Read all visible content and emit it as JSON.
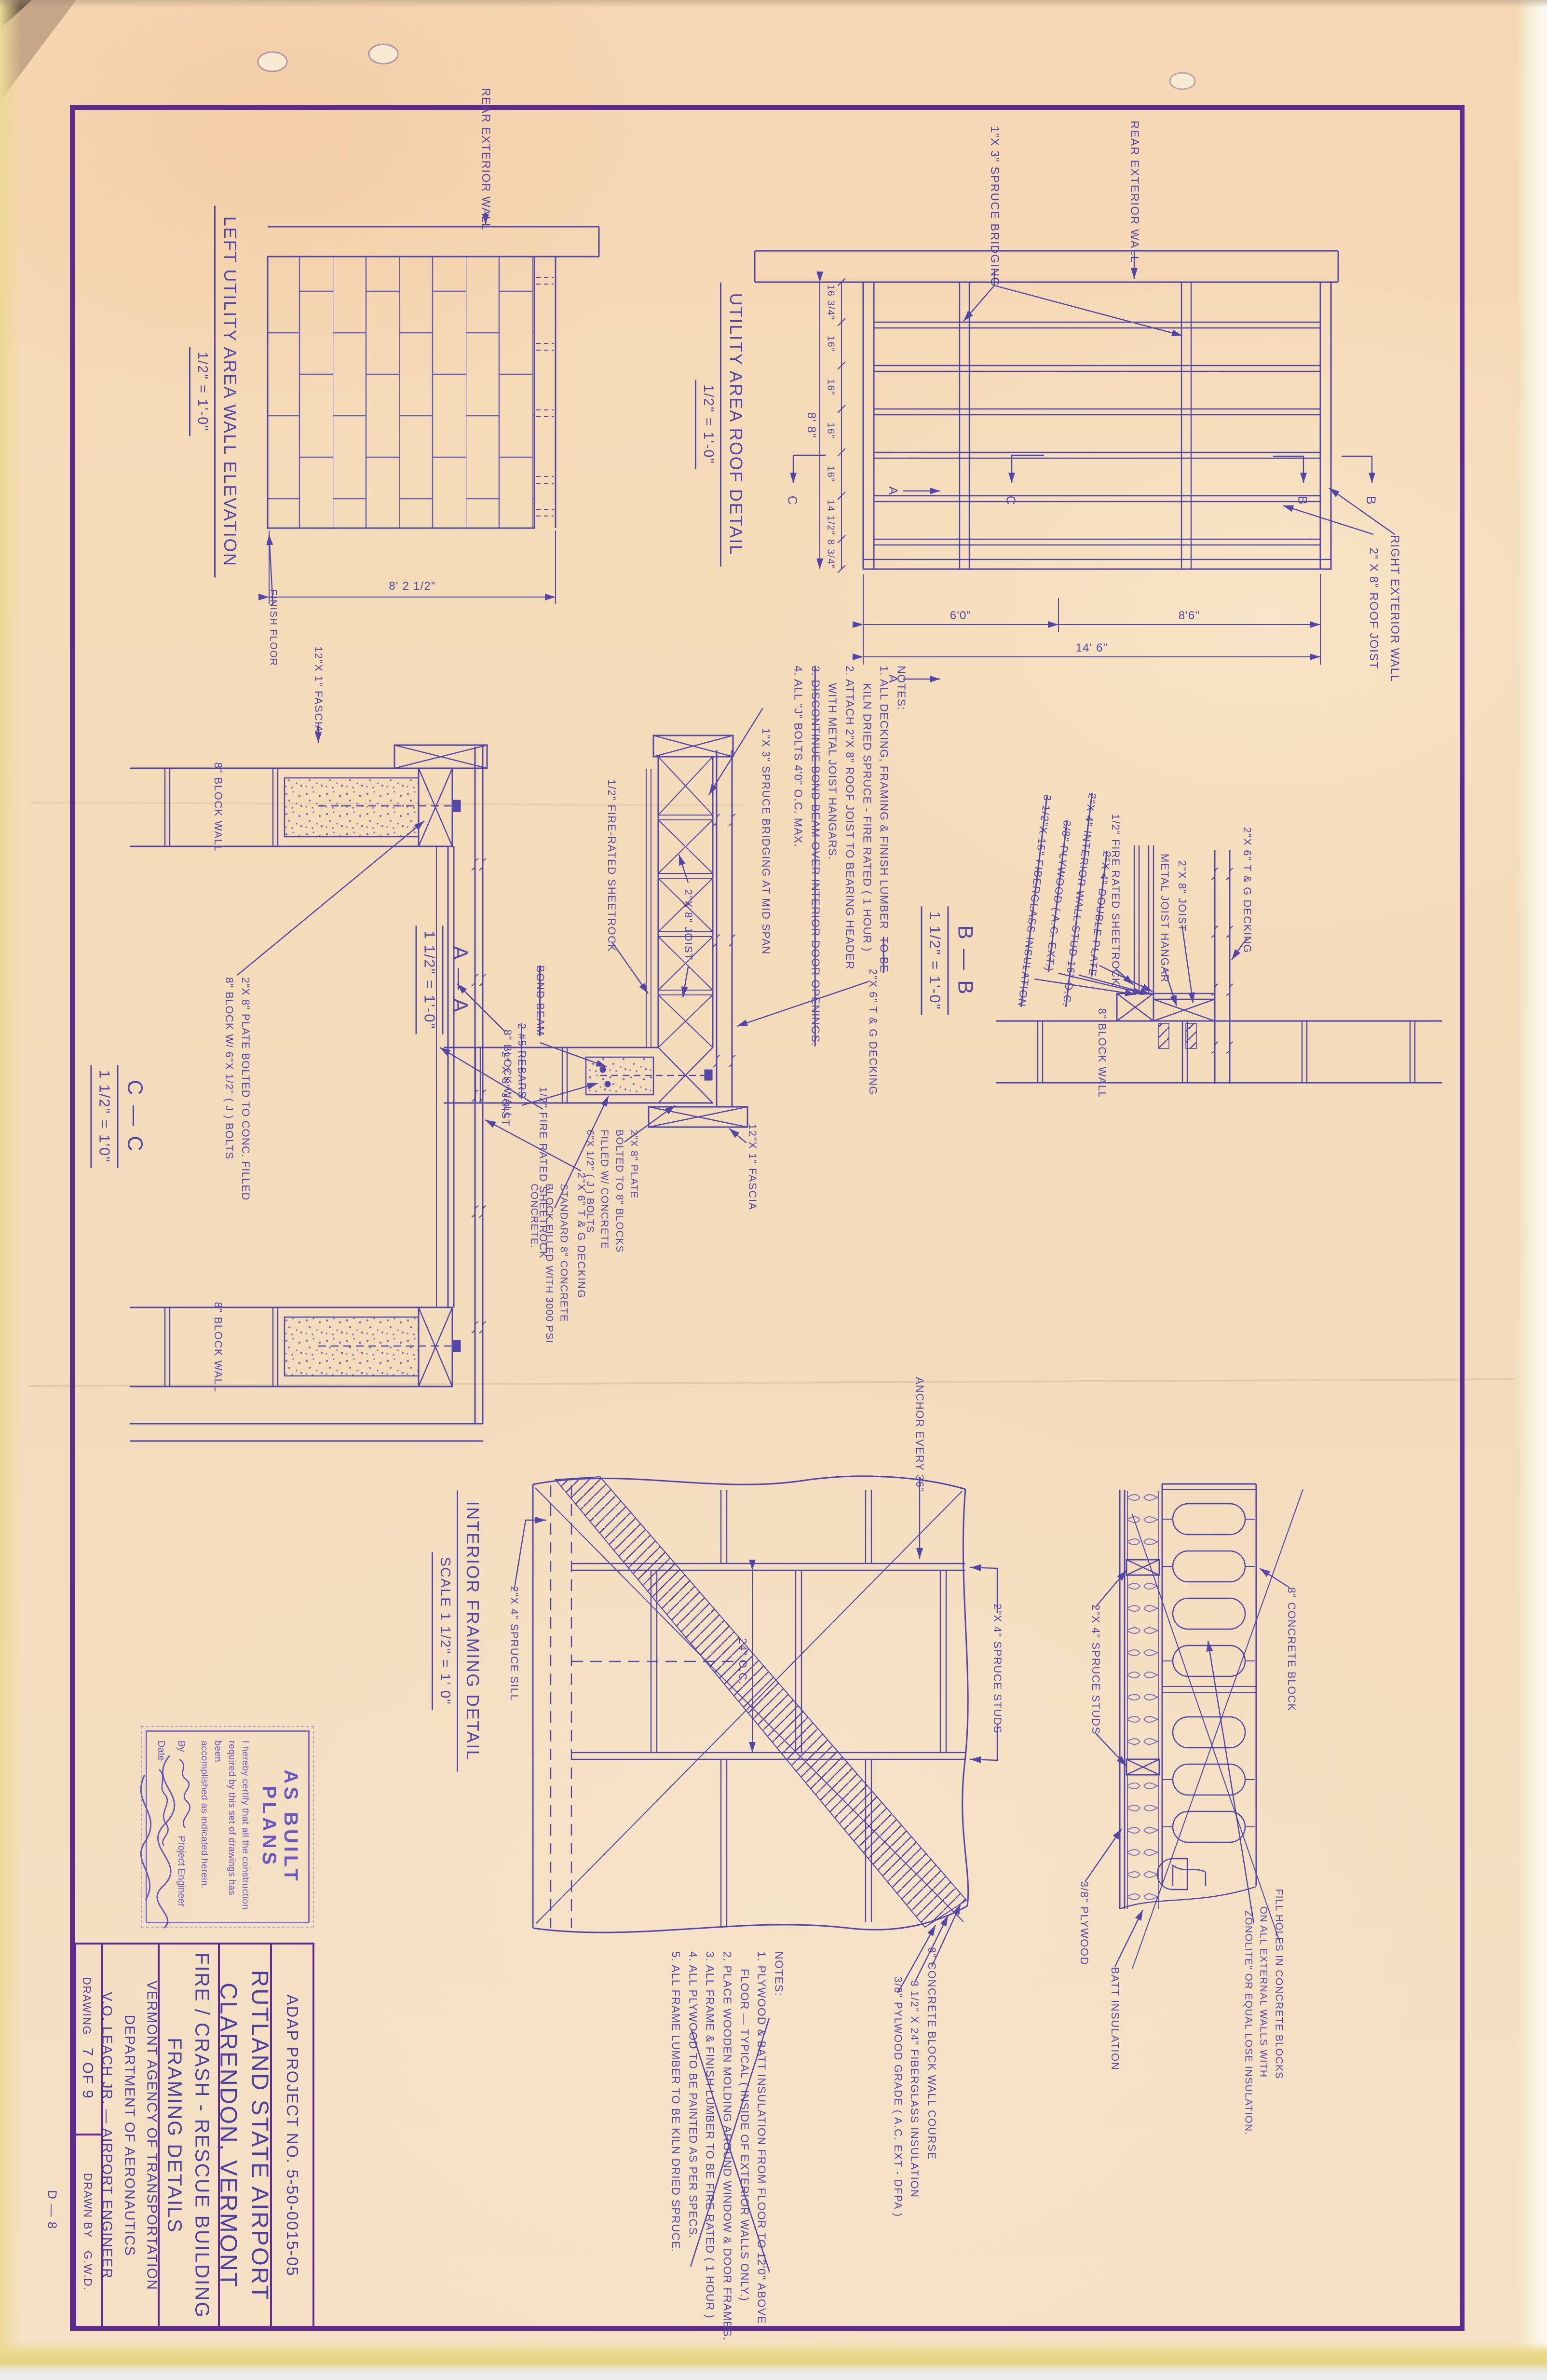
{
  "palette": {
    "paper": "#f4dcba",
    "ink": "#5246a8",
    "frame": "#5e2c90",
    "stamp": "#6a58c2"
  },
  "sheet": {
    "drawing_code": "D — 8",
    "title_block": {
      "project_no": "ADAP  PROJECT  NO.  5-50-0015-05",
      "airport_line1": "RUTLAND   STATE   AIRPORT",
      "airport_line2": "CLARENDON,  VERMONT",
      "subject_line1": "FIRE / CRASH - RESCUE  BUILDING",
      "subject_line2": "FRAMING   DETAILS",
      "agency_line1": "VERMONT  AGENCY  OF  TRANSPORTATION",
      "agency_line2": "DEPARTMENT  OF  AERONAUTICS",
      "agency_line3": "V.O. LEACH  JR.  —  AIRPORT  ENGINEER",
      "drawing_label": "DRAWING",
      "drawing_no": "7 OF 9",
      "drawn_by_label": "DRAWN BY",
      "drawn_by": "G.W.D."
    },
    "stamp": {
      "title": "AS BUILT PLANS",
      "line1": "I hereby certify that all the construction",
      "line2": "required by this set of drawings has been",
      "line3": "accomplished as indicated herein.",
      "by_label": "By",
      "by_role": "Project Engineer",
      "date_label": "Date"
    }
  },
  "elevation": {
    "title": "LEFT  UTILITY  AREA  WALL  ELEVATION",
    "scale": "1/2\" = 1'-0\"",
    "rear_wall": "REAR  EXTERIOR  WALL",
    "finish_floor": "FINISH  FLOOR",
    "width_dim": "8' 2 1/2\""
  },
  "roof": {
    "title": "UTILITY  AREA  ROOF  DETAIL",
    "scale": "1/2\" = 1'-0\"",
    "bridging": "1\"X 3\"  SPRUCE  BRIDGING",
    "rear_wall": "REAR  EXTERIOR  WALL",
    "right_wall": "RIGHT  EXTERIOR  WALL",
    "roof_joist": "2\" X 8\"  ROOF  JOIST",
    "dims_left": [
      "16 3/4\"",
      "16\"",
      "16\"",
      "16\"",
      "16\"",
      "14 1/2\"",
      "8 3/4\""
    ],
    "dim_left_overall": "8' 8\"",
    "dims_bottom": [
      "6'0\"",
      "8'6\""
    ],
    "dim_bottom_overall": "14' 6\"",
    "marker_a": "A",
    "marker_b": "B",
    "marker_c": "C"
  },
  "notes_top": {
    "heading": "NOTES:",
    "n1a": "1.  ALL DECKING, FRAMING & FINISH LUMBER",
    "n1_struck": "TO BE",
    "n1b": "KILN DRIED SPRUCE - FIRE RATED ( 1 HOUR )",
    "n2a": "2.  ATTACH 2\"X 8\" ROOF JOIST TO BEARING HEADER",
    "n2b": "WITH METAL JOIST HANGARS.",
    "n3": "3.  DISCONTINUE BOND BEAM OVER INTERIOR DOOR OPENINGS.",
    "n4": "4.  ALL \"J\" BOLTS 4'0\" O.C. MAX."
  },
  "section_c": {
    "label": "C — C",
    "scale": "1 1/2\" = 1'0\"",
    "fascia": "12\"X 1\" FASCIA",
    "block_wall": "8\" BLOCK  WALL",
    "block_wall2": "8\" BLOCK  WALL",
    "plate_l1": "2\"X 8\"  PLATE  BOLTED  TO  CONC.  FILLED",
    "plate_l2": "8\" BLOCK  W/ 6\"X 1/2\" ( J )  BOLTS",
    "joist": "2\" X 8\"  JOIST",
    "sheetrock": "1/2\"  FIRE  RATED  SHEETROCK",
    "decking": "2\"X 6\"  T & G  DECKING"
  },
  "section_a": {
    "label": "A — A",
    "scale": "1 1/2\" = 1'-0\"",
    "bridging": "1\"X 3\"  SPRUCE  BRIDGING  AT  MID  SPAN",
    "sheetrock": "1/2\"  FIRE-RATED  SHEETROCK",
    "joist": "2\"X 8\"  JOIST",
    "decking": "2\"X 6\"  T & G  DECKING",
    "bond_beam": "BOND  BEAM",
    "rebars": "2  #5  REBARS",
    "plate_l1": "2\"X 8\"  PLATE",
    "plate_l2": "BOLTED  TO  8\" BLOCKS",
    "plate_l3": "FILLED  W/  CONCRETE",
    "plate_l4": "6\"X 1/2\"  ( J ) BOLTS",
    "block_wall": "8\" BLOCK  WALL",
    "standard_l1": "STANDARD  8\"  CONCRETE",
    "standard_l2": "BLOCK  FILLED  WITH  3000 PSI",
    "standard_l3": "CONCRETE.",
    "fascia": "12\"X 1\"  FASCIA"
  },
  "section_b": {
    "label": "B — B",
    "scale": "1 1/2\" = 1'-0\"",
    "fiberglass": "3 1/2\"X 15\"  FIBERGLASS  INSULATION",
    "plywood": "3/8\"  PLYWOOD  ( A.C.  EXT.)",
    "stud": "2\"X 4\"  INTERIOR  WALL  STUD  16\"  O.C.",
    "double_plate": "2\"X 4\"  DOUBLE  PLATE",
    "sheetrock": "1/2\"  FIRE  RATED  SHEETROCK",
    "hangar": "METAL  JOIST  HANGAR",
    "joist": "2\"X 8\"  JOIST",
    "decking": "2\"X 6\"  T & G  DECKING",
    "block_wall": "8\" BLOCK  WALL"
  },
  "interior": {
    "title": "INTERIOR  FRAMING  DETAIL",
    "scale": "SCALE  1 1/2\" = 1' 0\"",
    "sill": "2\"X 4\"  SPRUCE  SILL",
    "anchor": "ANCHOR  EVERY  36\"",
    "oc": "24\" O.C.",
    "studs": "2\"X 4\"  SPRUCE  STUDS",
    "block_course": "8\"  CONCRETE  BLOCK  WALL  COURSE",
    "fiberglass": "3 1/2\" X 24\"  FIBERGLASS  INSULATION",
    "plywood": "3/8\"  PYLWOOD  GRADE  ( A.C.  EXT - DFPA )"
  },
  "wall_plan": {
    "studs": "2\"X 4\"  SPRUCE  STUDS",
    "block": "8\"  CONCRETE  BLOCK",
    "fill_l1": "FILL  HOLES  IN  CONCRETE  BLOCKS",
    "fill_l2": "ON  ALL  EXTERNAL  WALLS  WITH",
    "fill_l3": "\"ZONOLITE\"  OR  EQUAL  LOSE  INSULATION.",
    "plywood": "3/8\"  PLYWOOD",
    "batt": "BATT  INSULATION"
  },
  "notes_bottom": {
    "heading": "NOTES:",
    "n1a": "1.  PLYWOOD & BATT INSULATION FROM FLOOR TO 12'0\" ABOVE",
    "n1b": "FLOOR — TYPICAL ( INSIDE OF EXTERIOR WALLS ONLY.)",
    "n2": "2.  PLACE WOODEN MOLDING AROUND WINDOW & DOOR FRAMES.",
    "n3": "3.  ALL FRAME & FINISH LUMBER TO BE FIRE RATED ( 1 HOUR )",
    "n4": "4.  ALL PLYWOOD TO BE PAINTED AS PER SPECS.",
    "n5": "5.  ALL FRAME LUMBER TO BE KILN DRIED SPRUCE."
  }
}
